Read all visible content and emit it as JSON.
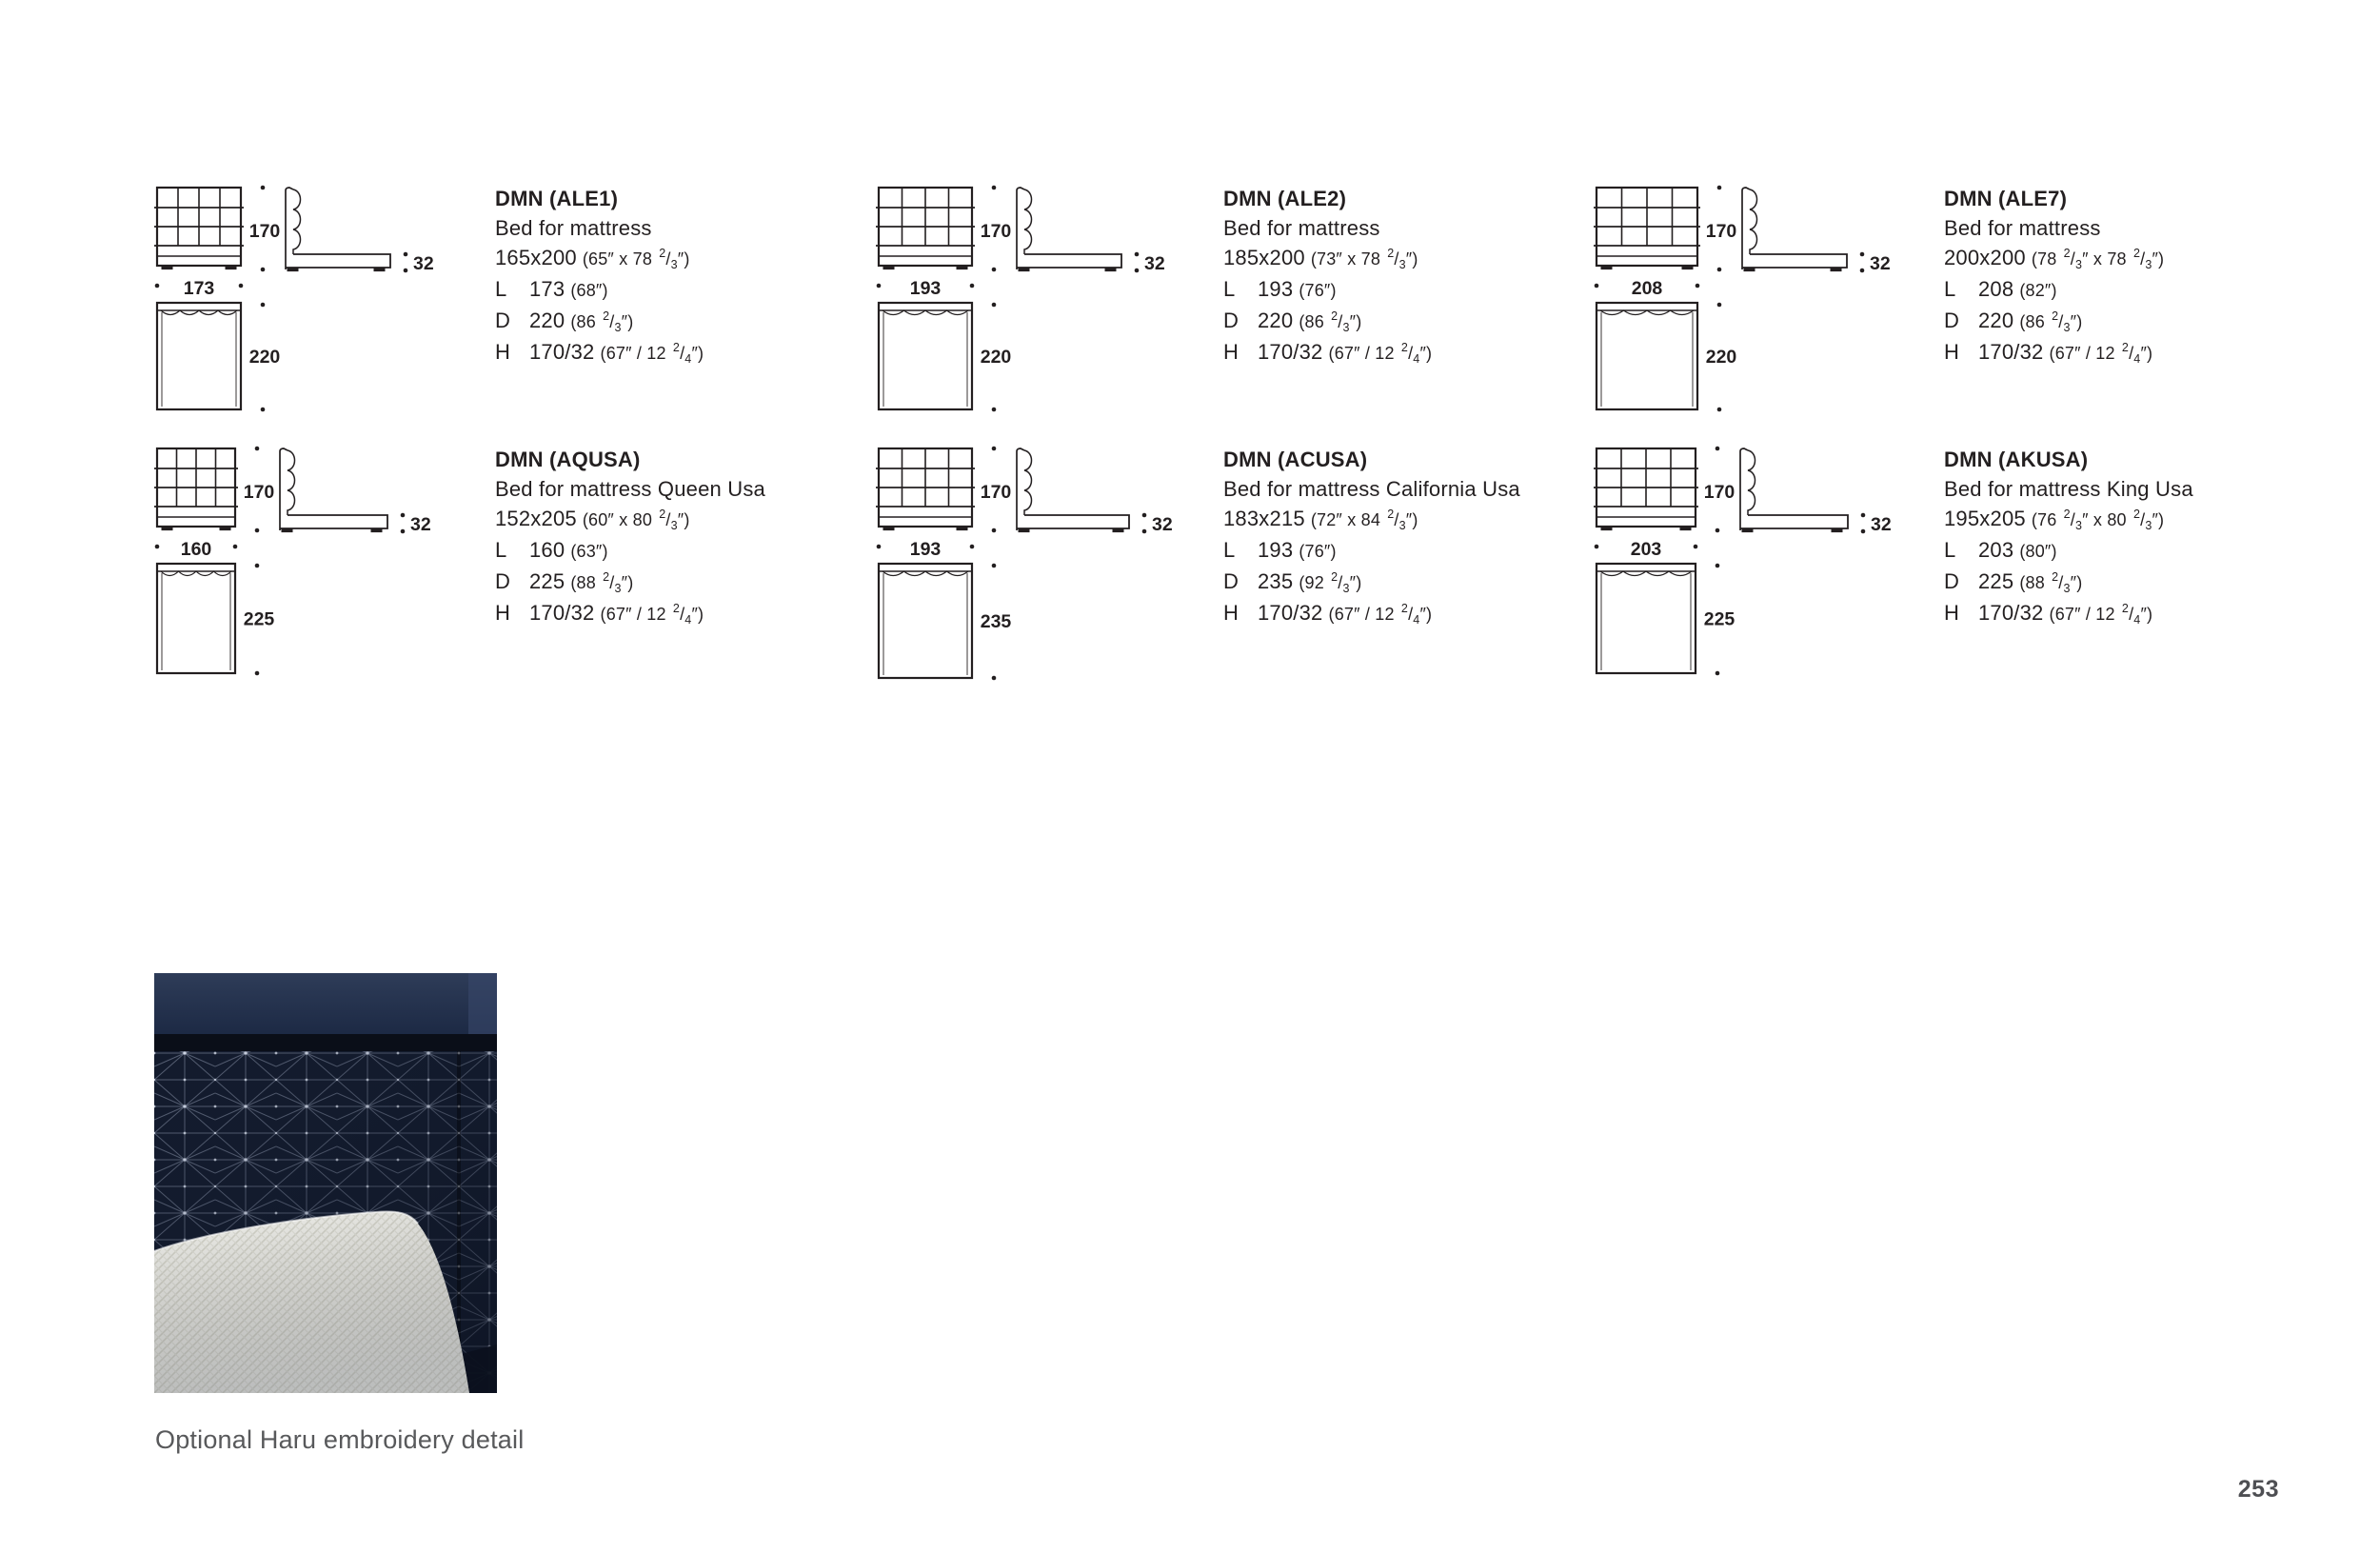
{
  "colors": {
    "ink": "#231f20",
    "caption_gray": "#58595b",
    "page_number_gray": "#4e4f53",
    "photo_navy": "#131b2d",
    "photo_band": "#2c3a55",
    "pillow_white": "#f1f1ec",
    "stitch": "#c3cde4"
  },
  "spec_labels": {
    "l": "L",
    "d": "D",
    "h": "H"
  },
  "products": [
    {
      "code": "DMN (ALE1)",
      "desc": "Bed for mattress",
      "size_cm": "165x200",
      "size_in": [
        "(65″ x 78 ",
        [
          "2",
          "3"
        ],
        "″)"
      ],
      "l_cm": "173",
      "l_in": [
        "(68″)"
      ],
      "d_cm": "220",
      "d_in": [
        "(86 ",
        [
          "2",
          "3"
        ],
        "″)"
      ],
      "h_cm": "170/32",
      "h_in": [
        "(67″ / 12 ",
        [
          "2",
          "4"
        ],
        "″)"
      ],
      "dims": {
        "height": "170",
        "width": "173",
        "frame": "32",
        "depth": "220"
      }
    },
    {
      "code": "DMN (ALE2)",
      "desc": "Bed for mattress",
      "size_cm": "185x200",
      "size_in": [
        "(73″ x 78 ",
        [
          "2",
          "3"
        ],
        "″)"
      ],
      "l_cm": "193",
      "l_in": [
        "(76″)"
      ],
      "d_cm": "220",
      "d_in": [
        "(86 ",
        [
          "2",
          "3"
        ],
        "″)"
      ],
      "h_cm": "170/32",
      "h_in": [
        "(67″ / 12 ",
        [
          "2",
          "4"
        ],
        "″)"
      ],
      "dims": {
        "height": "170",
        "width": "193",
        "frame": "32",
        "depth": "220"
      }
    },
    {
      "code": "DMN (ALE7)",
      "desc": "Bed for mattress",
      "size_cm": "200x200",
      "size_in": [
        "(78 ",
        [
          "2",
          "3"
        ],
        "″ x 78 ",
        [
          "2",
          "3"
        ],
        "″)"
      ],
      "l_cm": "208",
      "l_in": [
        "(82″)"
      ],
      "d_cm": "220",
      "d_in": [
        "(86 ",
        [
          "2",
          "3"
        ],
        "″)"
      ],
      "h_cm": "170/32",
      "h_in": [
        "(67″ / 12 ",
        [
          "2",
          "4"
        ],
        "″)"
      ],
      "dims": {
        "height": "170",
        "width": "208",
        "frame": "32",
        "depth": "220"
      }
    },
    {
      "code": "DMN (AQUSA)",
      "desc": "Bed for mattress Queen Usa",
      "size_cm": "152x205",
      "size_in": [
        "(60″ x 80 ",
        [
          "2",
          "3"
        ],
        "″)"
      ],
      "l_cm": "160",
      "l_in": [
        "(63″)"
      ],
      "d_cm": "225",
      "d_in": [
        "(88 ",
        [
          "2",
          "3"
        ],
        "″)"
      ],
      "h_cm": "170/32",
      "h_in": [
        "(67″ / 12 ",
        [
          "2",
          "4"
        ],
        "″)"
      ],
      "dims": {
        "height": "170",
        "width": "160",
        "frame": "32",
        "depth": "225"
      }
    },
    {
      "code": "DMN (ACUSA)",
      "desc": "Bed for mattress California Usa",
      "size_cm": "183x215",
      "size_in": [
        "(72″ x 84 ",
        [
          "2",
          "3"
        ],
        "″)"
      ],
      "l_cm": "193",
      "l_in": [
        "(76″)"
      ],
      "d_cm": "235",
      "d_in": [
        "(92 ",
        [
          "2",
          "3"
        ],
        "″)"
      ],
      "h_cm": "170/32",
      "h_in": [
        "(67″ / 12 ",
        [
          "2",
          "4"
        ],
        "″)"
      ],
      "dims": {
        "height": "170",
        "width": "193",
        "frame": "32",
        "depth": "235"
      }
    },
    {
      "code": "DMN (AKUSA)",
      "desc": "Bed for mattress King Usa",
      "size_cm": "195x205",
      "size_in": [
        "(76 ",
        [
          "2",
          "3"
        ],
        "″ x 80 ",
        [
          "2",
          "3"
        ],
        "″)"
      ],
      "l_cm": "203",
      "l_in": [
        "(80″)"
      ],
      "d_cm": "225",
      "d_in": [
        "(88 ",
        [
          "2",
          "3"
        ],
        "″)"
      ],
      "h_cm": "170/32",
      "h_in": [
        "(67″ / 12 ",
        [
          "2",
          "4"
        ],
        "″)"
      ],
      "dims": {
        "height": "170",
        "width": "203",
        "frame": "32",
        "depth": "225"
      }
    }
  ],
  "photo": {
    "caption": "Optional Haru embroidery detail"
  },
  "page": {
    "number": "253"
  }
}
